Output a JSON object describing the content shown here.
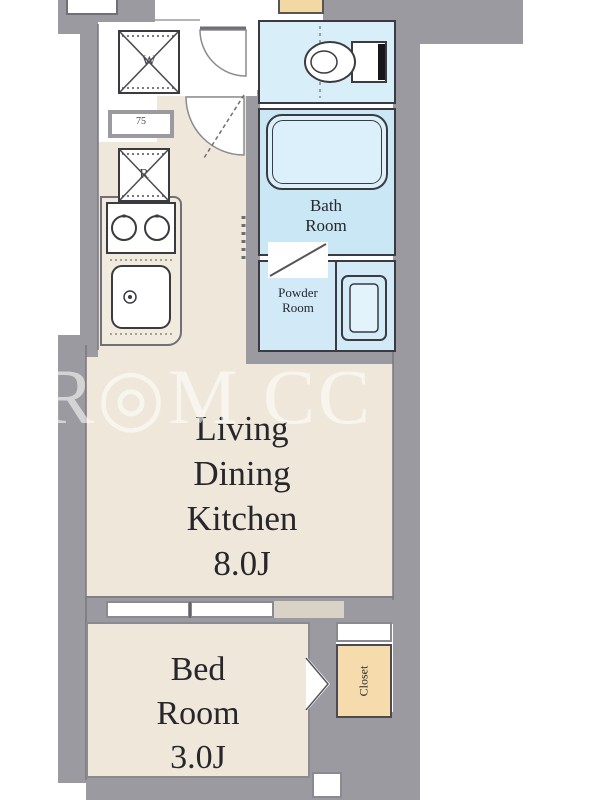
{
  "floorplan": {
    "watermark": "R◎M CC",
    "rooms": {
      "ldk": {
        "lines": [
          "Living",
          "Dining",
          "Kitchen"
        ],
        "size": "8.0J"
      },
      "bedroom": {
        "lines": [
          "Bed",
          "Room"
        ],
        "size": "3.0J"
      },
      "bathroom": {
        "lines": [
          "Bath",
          "Room"
        ]
      },
      "powder_room": {
        "lines": [
          "Powder",
          "Room"
        ]
      },
      "closet": {
        "label": "Closet"
      }
    },
    "appliances": {
      "washer_label": "W",
      "refrigerator_label": "R",
      "counter_label": "75"
    },
    "colors": {
      "wall": "#9A9AA0",
      "floor": "#EFE8DA",
      "wet_area": "#CDE9F7",
      "bathtub": "#DBF0FA",
      "closet": "#F6DCAC",
      "outline": "#3A3A40"
    }
  }
}
